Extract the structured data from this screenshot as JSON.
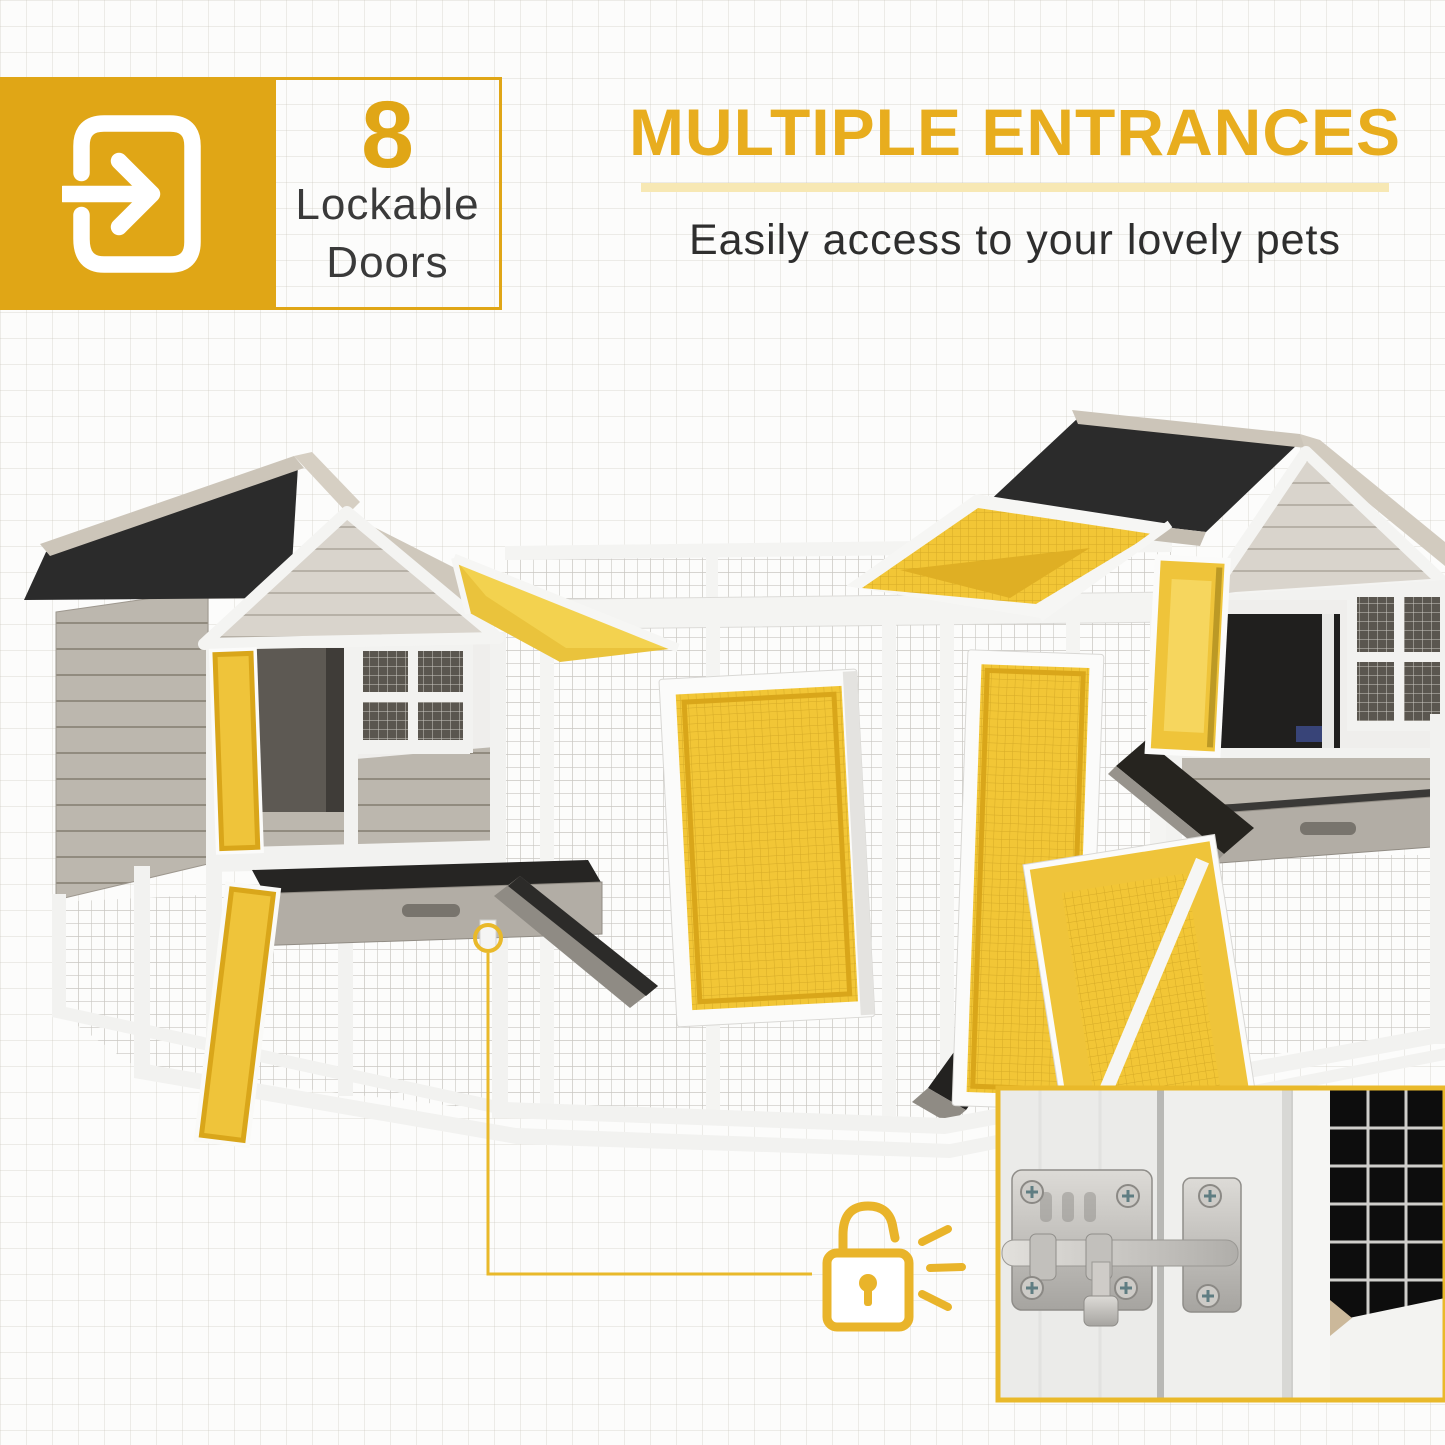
{
  "badge": {
    "icon": "door-enter-icon",
    "count": "8",
    "label_line1": "Lockable",
    "label_line2": "Doors"
  },
  "heading": {
    "title": "MULTIPLE ENTRANCES",
    "subtitle": "Easily access to your lovely pets"
  },
  "callout": {
    "icon": "padlock-icon",
    "marker": "latch-location-marker"
  },
  "inset": {
    "subject": "door-latch-closeup"
  },
  "product": {
    "subject": "double-wooden-pet-hutch-with-run"
  },
  "colors": {
    "accent_yellow": "#E0A616",
    "heading_yellow": "#E8AD1E",
    "divider_pale_yellow": "#F7E8B4",
    "highlight_yellow": "#F2C636",
    "roof_black": "#2B2B2B",
    "wood_gray": "#BCB7AE",
    "trim_white": "#F4F4F2",
    "text_dark": "#2E2E2E"
  }
}
